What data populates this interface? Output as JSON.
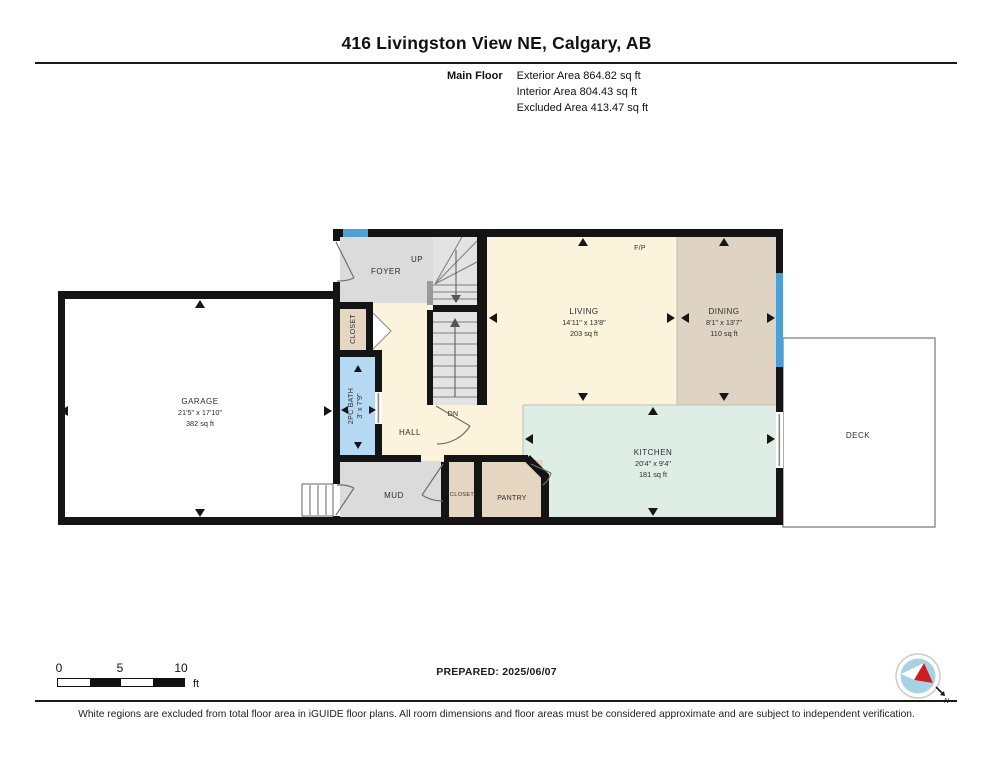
{
  "header": {
    "title": "416 Livingston View NE, Calgary, AB",
    "floor_label": "Main Floor",
    "stats": [
      "Exterior Area 864.82 sq ft",
      "Interior Area 804.43 sq ft",
      "Excluded Area 413.47 sq ft"
    ]
  },
  "rooms": {
    "garage": {
      "name": "GARAGE",
      "dims": "21'5\" x 17'10\"",
      "area": "382 sq ft"
    },
    "living": {
      "name": "LIVING",
      "dims": "14'11\" x 13'8\"",
      "area": "203 sq ft"
    },
    "dining": {
      "name": "DINING",
      "dims": "8'1\" x 13'7\"",
      "area": "110 sq ft"
    },
    "kitchen": {
      "name": "KITCHEN",
      "dims": "20'4\" x 9'4\"",
      "area": "181 sq ft"
    },
    "bath": {
      "name": "2PC BATH",
      "dims": "3' x 7'9\""
    },
    "foyer": {
      "name": "FOYER"
    },
    "hall": {
      "name": "HALL"
    },
    "mud": {
      "name": "MUD"
    },
    "closet_foyer": {
      "name": "CLOSET"
    },
    "closet_mud": {
      "name": "CLOSET"
    },
    "pantry": {
      "name": "PANTRY"
    },
    "deck": {
      "name": "DECK"
    }
  },
  "annotations": {
    "fireplace": "F/P",
    "up": "UP",
    "down": "DN",
    "north": "N"
  },
  "scale_bar": {
    "ticks": [
      "0",
      "5",
      "10"
    ],
    "unit": "ft"
  },
  "footer": {
    "prepared": "PREPARED: 2025/06/07",
    "disclaimer": "White regions are excluded from total floor area in iGUIDE floor plans. All room dimensions and floor areas must be considered approximate and are subject to independent verification."
  },
  "colors": {
    "wall": "#141414",
    "cream": "#FBF3DB",
    "gray_room": "#DBDBDB",
    "tan_room": "#E4D6C1",
    "dining": "#DFD4C3",
    "kitchen": "#DEEDE5",
    "bath": "#B5D9F3",
    "window": "#4D9FD6",
    "stair": "#E3E3E3",
    "deck_border": "#8A8A8A"
  }
}
